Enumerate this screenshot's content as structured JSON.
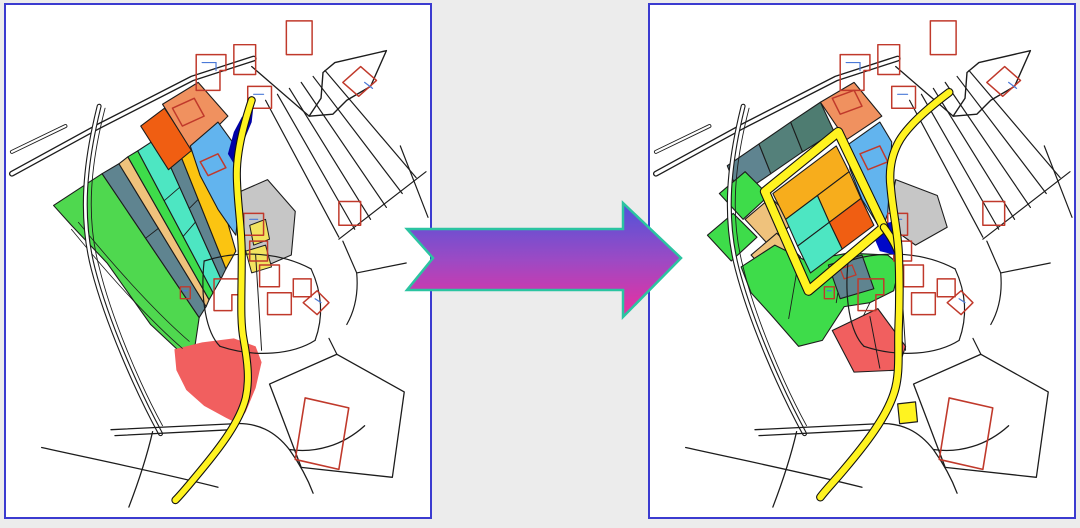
{
  "scene": {
    "background": "#ECECEC",
    "panel_border": "#3B3BD0",
    "panel_background": "#FFFFFF",
    "left_panel_name": "cadastral-map-before-consolidation",
    "right_panel_name": "cadastral-map-after-consolidation"
  },
  "palette": {
    "line": "#1C1C1C",
    "white": "#FFFFFF",
    "building": "#C0392B",
    "building_mark": "#4A79D8",
    "road_yellow": "#FFF320",
    "road_casing": "#111111",
    "green": "#4FD84F",
    "green_bright": "#3EDC4A",
    "slate": "#5F8490",
    "teal_mid": "#54807A",
    "teal_dark": "#4E7C71",
    "tan": "#EFC27C",
    "turquoise": "#4DE6C2",
    "gold": "#FBC411",
    "gold_cell": "#F7AD1C",
    "orange": "#F05E12",
    "salmon": "#F0915F",
    "light_blue": "#62B4EE",
    "navy": "#0000A6",
    "pond_blue": "#0008C8",
    "gray": "#C6C6C6",
    "pale_yellow": "#F2E360",
    "red": "#F15F5F"
  },
  "arrow": {
    "name": "transformation-arrow",
    "points": "407,229 623,229 623,203 681,258 623,317 623,290 407,290 433,258",
    "gradient": [
      "#4E53DA",
      "#9C4AC4",
      "#EE2E9E"
    ],
    "outline": "#2BC4A1",
    "outline_width": 2.5
  },
  "base_layers": [
    {
      "name": "road-main",
      "type": "droad",
      "d": "M6,170 L94,122 L188,74 L250,54",
      "w": 6
    },
    {
      "name": "road-upper-left",
      "type": "droad",
      "d": "M6,148 L60,122",
      "w": 4
    },
    {
      "name": "road-edge-to-funnel",
      "type": "path",
      "d": "M248,62 L306,112",
      "sw": 1.3
    },
    {
      "name": "road-funnel",
      "type": "poly",
      "points": "306,112 318,94 320,68 332,58 384,46 368,82 344,96 330,110",
      "fill": "white",
      "stroke": "line",
      "sw": 1.4
    },
    {
      "name": "field-track",
      "type": "droad",
      "d": "M94,102 C80,158 74,212 88,266 C102,320 132,388 156,432",
      "w": 5
    },
    {
      "name": "field-track-inner",
      "type": "path",
      "d": "M100,104 C86,158 80,212 94,264 C106,314 134,380 158,424",
      "sw": 0.9
    },
    {
      "name": "fan-line-1",
      "type": "path",
      "d": "M262,96 L336,234",
      "sw": 1.2
    },
    {
      "name": "fan-line-2",
      "type": "path",
      "d": "M274,90 L352,226",
      "sw": 1.2
    },
    {
      "name": "fan-line-3",
      "type": "path",
      "d": "M286,84 L368,216",
      "sw": 1.2
    },
    {
      "name": "fan-line-4",
      "type": "path",
      "d": "M298,78 L384,204",
      "sw": 1.2
    },
    {
      "name": "fan-line-5",
      "type": "path",
      "d": "M310,72 L400,190",
      "sw": 1.2
    },
    {
      "name": "fan-line-6",
      "type": "path",
      "d": "M322,66 L414,174",
      "sw": 1.2
    },
    {
      "name": "fan-transverse",
      "type": "path",
      "d": "M336,236 L424,168",
      "sw": 1.2
    },
    {
      "name": "boundary-right",
      "type": "path",
      "d": "M340,238 L354,270 C356,292 352,308 344,322",
      "sw": 1.2
    },
    {
      "name": "boundary-right-2",
      "type": "path",
      "d": "M354,270 L404,260",
      "sw": 1.2
    },
    {
      "name": "boundary-right-3",
      "type": "path",
      "d": "M398,142 L426,214",
      "sw": 1.2
    },
    {
      "name": "cluster-arc-top",
      "type": "path",
      "d": "M200,258 C238,246 278,250 308,266",
      "sw": 1.2
    },
    {
      "name": "cluster-arc-left",
      "type": "path",
      "d": "M200,258 C196,296 202,330 216,344",
      "sw": 1.2
    },
    {
      "name": "cluster-arc-bottom",
      "type": "path",
      "d": "M216,344 C252,356 290,352 312,338",
      "sw": 1.2
    },
    {
      "name": "cluster-arc-right",
      "type": "path",
      "d": "M308,266 C320,292 320,316 312,338",
      "sw": 1.2
    },
    {
      "name": "cluster-divider",
      "type": "path",
      "d": "M252,252 L258,348",
      "sw": 1
    },
    {
      "name": "bottom-road-1",
      "type": "path",
      "d": "M106,428 L230,422",
      "sw": 1.3
    },
    {
      "name": "bottom-road-2",
      "type": "path",
      "d": "M110,434 L228,428",
      "sw": 1.3
    },
    {
      "name": "bottom-road-3",
      "type": "path",
      "d": "M36,446 C90,458 150,470 214,486",
      "sw": 1.3
    },
    {
      "name": "bottom-road-4",
      "type": "path",
      "d": "M228,422 C254,420 272,430 286,448 C296,462 304,476 310,492",
      "sw": 1.3
    },
    {
      "name": "bottom-road-5",
      "type": "path",
      "d": "M286,448 C312,452 340,444 362,424",
      "sw": 1.3
    },
    {
      "name": "bottom-road-6",
      "type": "path",
      "d": "M148,430 C142,456 134,480 124,506",
      "sw": 1.3
    },
    {
      "name": "parcel-bottom-right",
      "type": "poly",
      "points": "266,382 334,352 402,390 390,476 298,466",
      "fill": "none",
      "stroke": "line",
      "sw": 1.3
    },
    {
      "name": "parcel-bottom-right-link",
      "type": "path",
      "d": "M334,352 L326,336",
      "sw": 1.2
    },
    {
      "name": "house",
      "type": "poly",
      "points": "192,50 222,50 222,66 216,66 216,86 192,86",
      "fill": "none",
      "stroke": "building",
      "sw": 1.5
    },
    {
      "name": "house-mark",
      "type": "path",
      "d": "M198,58 L212,58 L212,66",
      "stroke": "building_mark",
      "sw": 1.2
    },
    {
      "name": "house",
      "type": "poly",
      "points": "230,40 252,40 252,70 230,70",
      "fill": "none",
      "stroke": "building",
      "sw": 1.5
    },
    {
      "name": "house",
      "type": "poly",
      "points": "244,82 268,82 268,104 244,104",
      "fill": "none",
      "stroke": "building",
      "sw": 1.5
    },
    {
      "name": "house-mark",
      "type": "path",
      "d": "M250,90 L260,90",
      "stroke": "building_mark",
      "sw": 1.2
    },
    {
      "name": "house",
      "type": "poly",
      "points": "283,16 309,16 309,50 283,50",
      "fill": "none",
      "stroke": "building",
      "sw": 1.5
    },
    {
      "name": "house",
      "type": "poly",
      "points": "340,78 358,62 374,76 356,92",
      "fill": "none",
      "stroke": "building",
      "sw": 1.5
    },
    {
      "name": "house-mark",
      "type": "path",
      "d": "M362,78 L370,84",
      "stroke": "building_mark",
      "sw": 1.2
    },
    {
      "name": "house",
      "type": "poly",
      "points": "336,198 358,198 358,222 336,222",
      "fill": "none",
      "stroke": "building",
      "sw": 1.5
    },
    {
      "name": "house",
      "type": "poly",
      "points": "240,210 260,210 260,232 240,232",
      "fill": "none",
      "stroke": "building",
      "sw": 1.5
    },
    {
      "name": "house-mark",
      "type": "path",
      "d": "M246,216 L254,216",
      "stroke": "building_mark",
      "sw": 1.2
    },
    {
      "name": "house",
      "type": "poly",
      "points": "246,238 264,238 264,258 246,258",
      "fill": "none",
      "stroke": "building",
      "sw": 1.5
    },
    {
      "name": "house",
      "type": "poly",
      "points": "210,276 236,276 236,292 228,292 228,308 210,308",
      "fill": "none",
      "stroke": "building",
      "sw": 1.5
    },
    {
      "name": "house",
      "type": "poly",
      "points": "256,262 276,262 276,284 256,284",
      "fill": "none",
      "stroke": "building",
      "sw": 1.5
    },
    {
      "name": "house",
      "type": "poly",
      "points": "264,290 288,290 288,312 264,312",
      "fill": "none",
      "stroke": "building",
      "sw": 1.5
    },
    {
      "name": "house",
      "type": "poly",
      "points": "290,276 308,276 308,294 290,294",
      "fill": "none",
      "stroke": "building",
      "sw": 1.5
    },
    {
      "name": "house",
      "type": "poly",
      "points": "300,300 314,288 326,300 314,312",
      "fill": "none",
      "stroke": "building",
      "sw": 1.5
    },
    {
      "name": "house-mark",
      "type": "path",
      "d": "M312,296 L318,300",
      "stroke": "building_mark",
      "sw": 1.2
    },
    {
      "name": "house-large",
      "type": "poly",
      "points": "302,396 346,406 336,468 292,458",
      "fill": "none",
      "stroke": "building",
      "sw": 1.6
    },
    {
      "name": "house-small",
      "type": "poly",
      "points": "176,284 186,284 186,296 176,296",
      "fill": "none",
      "stroke": "building",
      "sw": 1.4
    },
    {
      "name": "house-mark",
      "type": "path",
      "d": "M179,288 L183,288",
      "stroke": "building_mark",
      "sw": 1.2
    }
  ],
  "left_panel": {
    "under": [
      {
        "name": "strip-green-large",
        "type": "poly",
        "points": "48,202 97,170 195,315 191,342 176,350 146,322 102,260 66,222",
        "fill": "green",
        "stroke": "line",
        "sw": 1.1
      },
      {
        "name": "strip-slate",
        "type": "poly",
        "points": "97,170 114,160 202,304 195,315",
        "fill": "slate",
        "stroke": "line",
        "sw": 1.1
      },
      {
        "name": "strip-tan",
        "type": "poly",
        "points": "114,160 123,153 205,297 202,304",
        "fill": "tan",
        "stroke": "line",
        "sw": 1.1
      },
      {
        "name": "strip-green-narrow",
        "type": "poly",
        "points": "123,153 133,147 209,290 205,297",
        "fill": "green_bright",
        "stroke": "line",
        "sw": 1.1
      },
      {
        "name": "strip-turquoise",
        "type": "poly",
        "points": "133,147 153,134 217,276 209,290",
        "fill": "turquoise",
        "stroke": "line",
        "sw": 1.1
      },
      {
        "name": "strip-slate-2",
        "type": "poly",
        "points": "153,134 166,126 222,266 217,276",
        "fill": "slate",
        "stroke": "line",
        "sw": 1.1
      },
      {
        "name": "strip-gold",
        "type": "poly",
        "points": "166,126 192,109 232,248 222,266",
        "fill": "gold",
        "stroke": "line",
        "sw": 1.1
      },
      {
        "name": "parcel-orange",
        "type": "poly",
        "points": "136,122 160,104 188,146 164,166",
        "fill": "orange",
        "stroke": "line",
        "sw": 1.1
      },
      {
        "name": "parcel-salmon",
        "type": "poly",
        "points": "158,100 194,78 224,112 188,148",
        "fill": "salmon",
        "stroke": "line",
        "sw": 1.1
      },
      {
        "name": "parcel-blue",
        "type": "poly",
        "points": "186,142 214,118 230,140 236,168 234,214 232,232 214,206 196,172",
        "fill": "light_blue",
        "stroke": "line",
        "sw": 1.1
      },
      {
        "name": "parcel-gray",
        "type": "poly",
        "points": "232,190 264,176 292,208 288,252 260,264 240,246",
        "fill": "gray",
        "stroke": "line",
        "sw": 1.1
      },
      {
        "name": "parcel-pale-yellow",
        "type": "poly",
        "points": "246,222 262,216 266,236 250,242",
        "fill": "pale_yellow",
        "stroke": "line",
        "sw": 1
      },
      {
        "name": "parcel-pale-yellow",
        "type": "poly",
        "points": "242,248 262,242 268,264 248,270",
        "fill": "pale_yellow",
        "stroke": "line",
        "sw": 1
      },
      {
        "name": "parcel-red-blob",
        "type": "poly",
        "points": "170,347 198,340 230,336 252,344 258,360 252,386 242,410 234,422 222,416 200,404 182,388 172,368",
        "fill": "red",
        "stroke": "none",
        "sw": 0
      },
      {
        "name": "green-track-line",
        "type": "path",
        "d": "M66,226 C110,280 150,322 178,346",
        "sw": 0.8
      },
      {
        "name": "green-track-line",
        "type": "path",
        "d": "M73,219 C117,273 157,315 185,339",
        "sw": 0.8
      },
      {
        "name": "strip-divider",
        "type": "path",
        "d": "M141,235 L154,225",
        "sw": 0.9
      },
      {
        "name": "strip-divider",
        "type": "path",
        "d": "M160,197 L175,184",
        "sw": 0.9
      },
      {
        "name": "strip-divider",
        "type": "path",
        "d": "M179,233 L191,219",
        "sw": 0.9
      },
      {
        "name": "strip-divider",
        "type": "path",
        "d": "M185,205 L194,196",
        "sw": 0.9
      },
      {
        "name": "house",
        "type": "poly",
        "points": "168,104 190,94 200,112 178,122",
        "fill": "none",
        "stroke": "building",
        "sw": 1.5
      },
      {
        "name": "house",
        "type": "poly",
        "points": "196,158 214,150 222,164 204,172",
        "fill": "none",
        "stroke": "building",
        "sw": 1.5
      }
    ],
    "over": [
      {
        "name": "stream-navy",
        "type": "poly",
        "points": "224,150 230,128 238,113 250,100 248,118 238,142 230,160",
        "fill": "navy",
        "stroke": "none",
        "sw": 0
      },
      {
        "name": "road-yellow",
        "type": "yroad",
        "d": "M248,96 C240,120 233,146 233,170 C233,198 238,222 238,252 C238,292 236,318 240,338 C244,360 246,378 242,396 C236,420 216,446 196,470 C186,482 178,492 171,499",
        "w": 6
      }
    ]
  },
  "right_panel": {
    "under": [
      {
        "name": "cell-slate",
        "type": "poly",
        "points": "78,162 110,140 122,170 90,192",
        "fill": "slate",
        "stroke": "line",
        "sw": 1.1
      },
      {
        "name": "cell-teal",
        "type": "poly",
        "points": "110,140 142,118 154,148 122,170",
        "fill": "teal_mid",
        "stroke": "line",
        "sw": 1.1
      },
      {
        "name": "cell-teal-dark",
        "type": "poly",
        "points": "142,118 172,98 186,128 154,148",
        "fill": "teal_dark",
        "stroke": "line",
        "sw": 1.1
      },
      {
        "name": "parcel-salmon",
        "type": "poly",
        "points": "172,98 206,78 234,112 198,136",
        "fill": "salmon",
        "stroke": "line",
        "sw": 1.1
      },
      {
        "name": "parcel-blue",
        "type": "poly",
        "points": "198,142 232,118 244,138 242,176 240,210 234,228 214,196 202,166",
        "fill": "light_blue",
        "stroke": "line",
        "sw": 1.1
      },
      {
        "name": "cell-green",
        "type": "poly",
        "points": "70,190 96,168 120,192 94,216",
        "fill": "green_bright",
        "stroke": "line",
        "sw": 1.1
      },
      {
        "name": "cell-green",
        "type": "poly",
        "points": "58,232 84,210 108,234 82,258",
        "fill": "green_bright",
        "stroke": "line",
        "sw": 1.1
      },
      {
        "name": "cell-tan",
        "type": "poly",
        "points": "96,216 122,194 146,218 120,242",
        "fill": "tan",
        "stroke": "line",
        "sw": 1.1
      },
      {
        "name": "cell-tan",
        "type": "poly",
        "points": "102,252 128,230 152,254 126,278",
        "fill": "tan",
        "stroke": "line",
        "sw": 1.1
      },
      {
        "name": "area-green-large",
        "type": "poly",
        "points": "92,264 126,242 158,258 200,250 240,252 252,262 246,288 222,300 196,304 174,338 150,344 122,312 102,290",
        "fill": "green_bright",
        "stroke": "line",
        "sw": 1.1
      },
      {
        "name": "green-division",
        "type": "path",
        "d": "M150,258 L140,316",
        "sw": 0.9
      },
      {
        "name": "green-division",
        "type": "path",
        "d": "M196,252 L188,300",
        "sw": 0.9
      },
      {
        "name": "green-division",
        "type": "path",
        "d": "M222,300 L204,336",
        "sw": 0.9
      },
      {
        "name": "cell-slate-small",
        "type": "poly",
        "points": "180,262 214,252 226,286 192,296",
        "fill": "slate",
        "stroke": "line",
        "sw": 1.1
      },
      {
        "name": "block-cell-gold",
        "type": "poly",
        "points": "188,142 201,168 137,216 124,190",
        "fill": "gold_cell",
        "stroke": "line",
        "sw": 1.1
      },
      {
        "name": "block-cell-gold",
        "type": "poly",
        "points": "201,168 213,195 181,219 169,192",
        "fill": "gold_cell",
        "stroke": "line",
        "sw": 1.1
      },
      {
        "name": "block-cell-turquoise",
        "type": "poly",
        "points": "169,192 181,219 149,243 137,216",
        "fill": "turquoise",
        "stroke": "line",
        "sw": 1.1
      },
      {
        "name": "block-cell-orange",
        "type": "poly",
        "points": "213,195 226,222 194,246 181,219",
        "fill": "orange",
        "stroke": "line",
        "sw": 1.1
      },
      {
        "name": "block-cell-turquoise",
        "type": "poly",
        "points": "181,219 194,246 162,270 149,243",
        "fill": "turquoise",
        "stroke": "line",
        "sw": 1.1
      },
      {
        "name": "parcel-gray",
        "type": "poly",
        "points": "248,176 290,192 300,224 268,242 246,226 244,196",
        "fill": "gray",
        "stroke": "line",
        "sw": 1.1
      },
      {
        "name": "parcel-red",
        "type": "poly",
        "points": "184,328 230,306 258,344 250,368 206,370",
        "fill": "red",
        "stroke": "line",
        "sw": 1.1
      },
      {
        "name": "red-divider",
        "type": "path",
        "d": "M222,314 L232,366",
        "sw": 1
      },
      {
        "name": "house",
        "type": "poly",
        "points": "184,94 206,86 214,102 192,110",
        "fill": "none",
        "stroke": "building",
        "sw": 1.5
      },
      {
        "name": "house",
        "type": "poly",
        "points": "212,150 232,142 240,158 220,166",
        "fill": "none",
        "stroke": "building",
        "sw": 1.5
      },
      {
        "name": "house-small",
        "type": "poly",
        "points": "192,266 204,262 208,272 196,276",
        "fill": "none",
        "stroke": "building",
        "sw": 1.3
      }
    ],
    "over": [
      {
        "name": "pond-navy",
        "type": "poly",
        "points": "230,222 246,218 254,234 248,252 232,248 226,234",
        "fill": "pond_blue",
        "stroke": "none",
        "sw": 0
      },
      {
        "name": "road-yellow-ring",
        "type": "yroad",
        "d": "M190,128 L236,224 L160,288 L116,188 Z",
        "w": 8
      },
      {
        "name": "road-yellow-stub",
        "type": "yroad",
        "d": "M236,224 C242,232 247,240 250,248",
        "w": 6
      },
      {
        "name": "road-yellow-main",
        "type": "yroad",
        "d": "M302,88 C278,106 258,124 250,140 C243,154 241,168 243,184 C245,208 250,228 251,250 C252,274 252,300 251,324 C250,348 253,372 246,392 C238,416 218,442 196,468 C186,480 178,488 172,496",
        "w": 6.5
      },
      {
        "name": "parcel-yellow-square",
        "type": "poly",
        "points": "250,402 268,400 270,420 252,422",
        "fill": "road_yellow",
        "stroke": "line",
        "sw": 1.2
      }
    ]
  }
}
